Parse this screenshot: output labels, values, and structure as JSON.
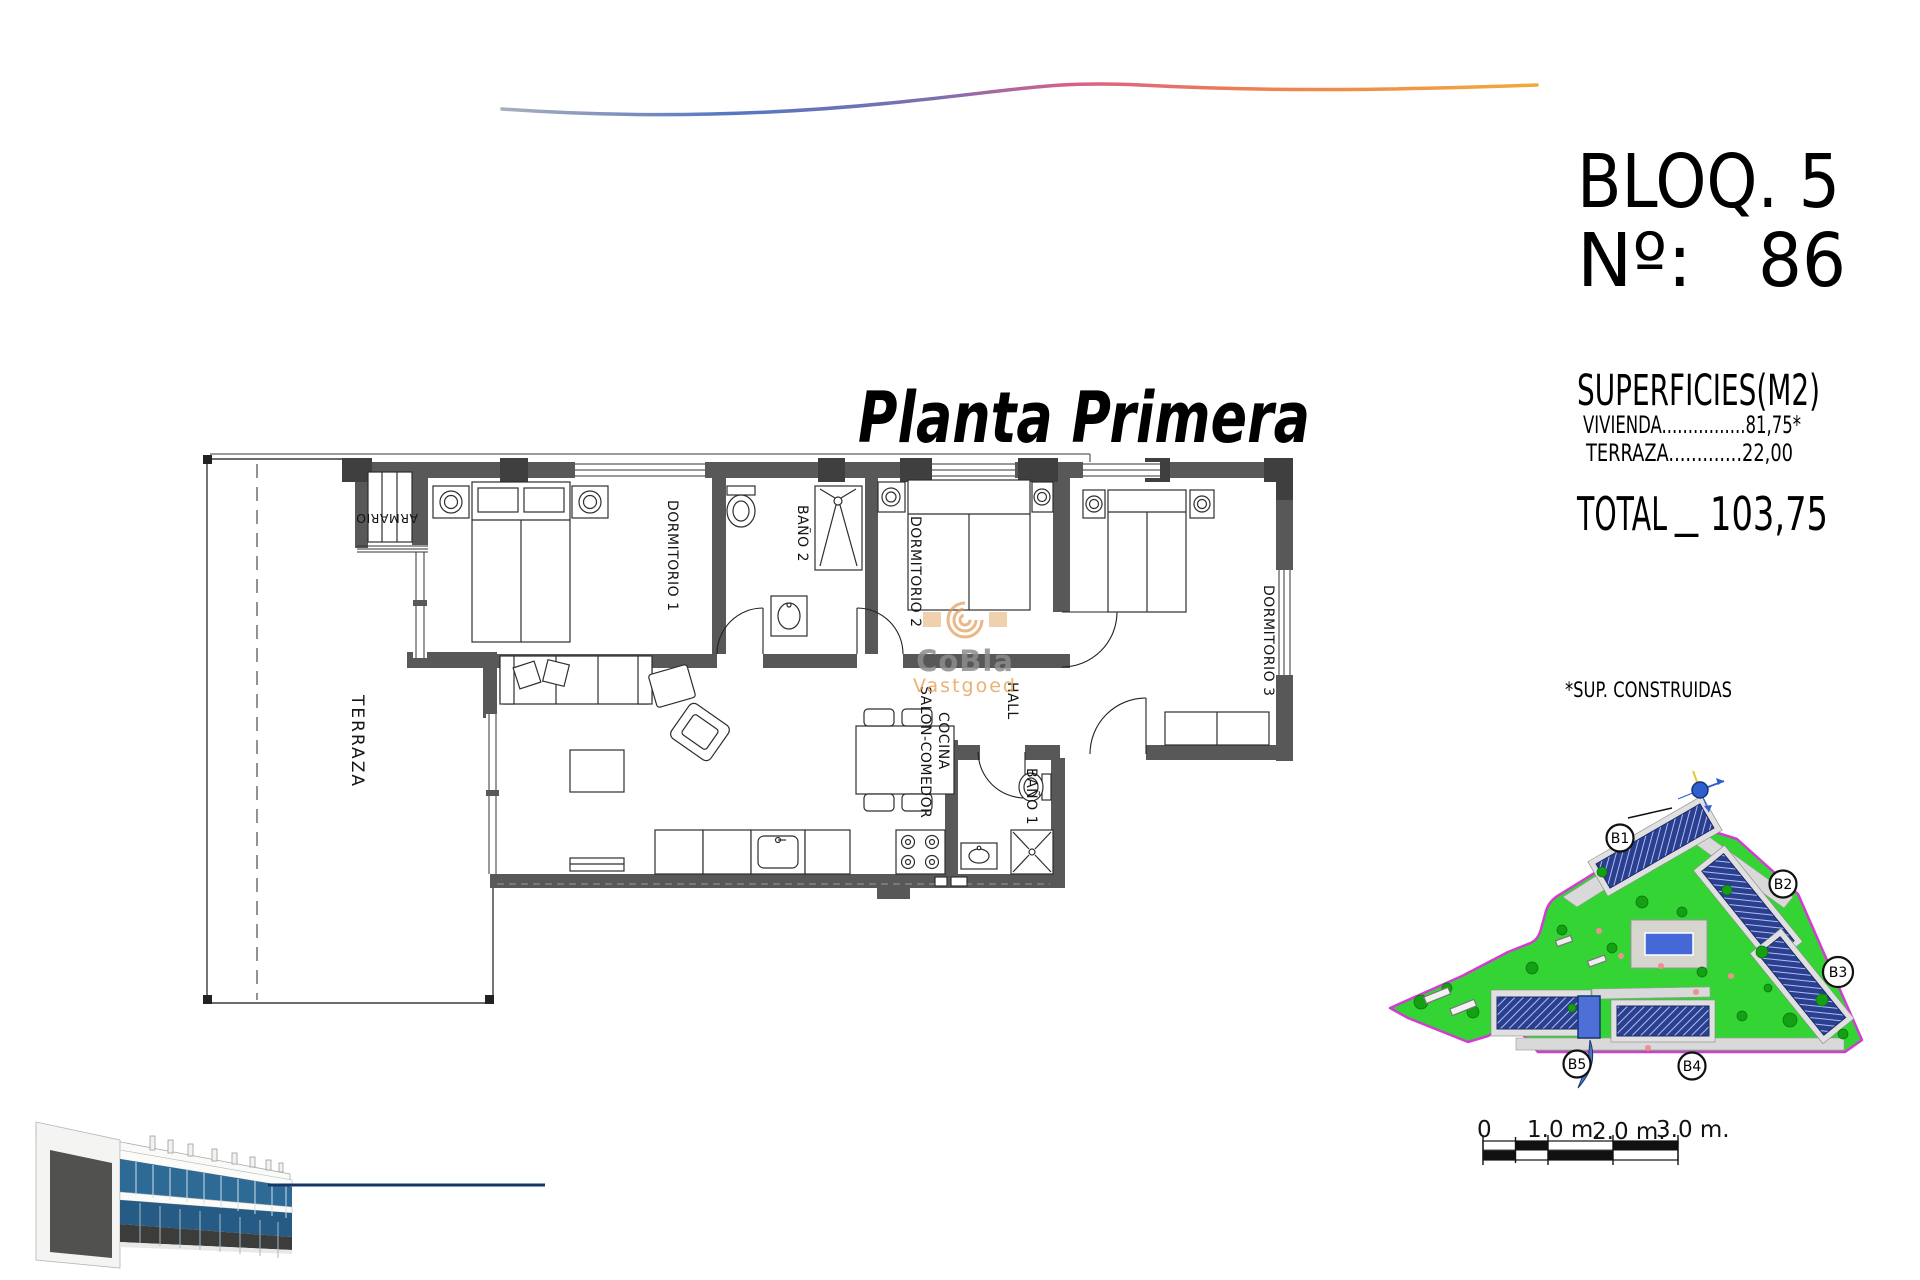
{
  "header": {
    "block_label": "BLOQ. 5",
    "number_label": "Nº:",
    "number_value": "86"
  },
  "title": {
    "script": "Planta Primera"
  },
  "superficies": {
    "heading": "SUPERFICIES(M2)",
    "rows": [
      "VIVIENDA................81,75*",
      "TERRAZA.............22,00"
    ],
    "total_label": "TOTAL",
    "total_sep": "_",
    "total_value": "103,75",
    "footnote": "*SUP. CONSTRUIDAS"
  },
  "plan": {
    "rooms": {
      "terraza": "TERRAZA",
      "armario": "ARMARIO",
      "dormitorio1": "DORMITORIO 1",
      "bano2": "BAÑO 2",
      "dormitorio2": "DORMITORIO 2",
      "dormitorio3": "DORMITORIO 3",
      "salon": "SALON-COMEDOR",
      "cocina": "COCINA",
      "hall": "HALL",
      "bano1": "BAÑO 1"
    },
    "colors": {
      "wall": "#585858",
      "pillar": "#3f3f3f",
      "line": "#2a2a2a"
    }
  },
  "watermark": {
    "brand": "CoBla",
    "sub": "Vastgoed",
    "brand_color": "#8c8c8c",
    "accent_color": "#e2954f"
  },
  "siteplan": {
    "blocks": [
      "B1",
      "B2",
      "B3",
      "B4",
      "B5"
    ],
    "colors": {
      "grass": "#35d435",
      "boundary": "#d43bd4",
      "building": "#2b3f8f",
      "pool": "#4468d8",
      "highlight": "#4f6fd8",
      "path": "#d9d9d9"
    }
  },
  "scalebar": {
    "labels": [
      "0",
      "1.0 m.",
      "2.0 m.",
      "3.0 m."
    ]
  },
  "render": {
    "accent_line_color": "#16366b"
  },
  "swoosh": {
    "gradient": [
      "#a8aebd",
      "#5577c0",
      "#7d6fb0",
      "#d95f8a",
      "#ef7f52",
      "#f2a93c"
    ]
  }
}
